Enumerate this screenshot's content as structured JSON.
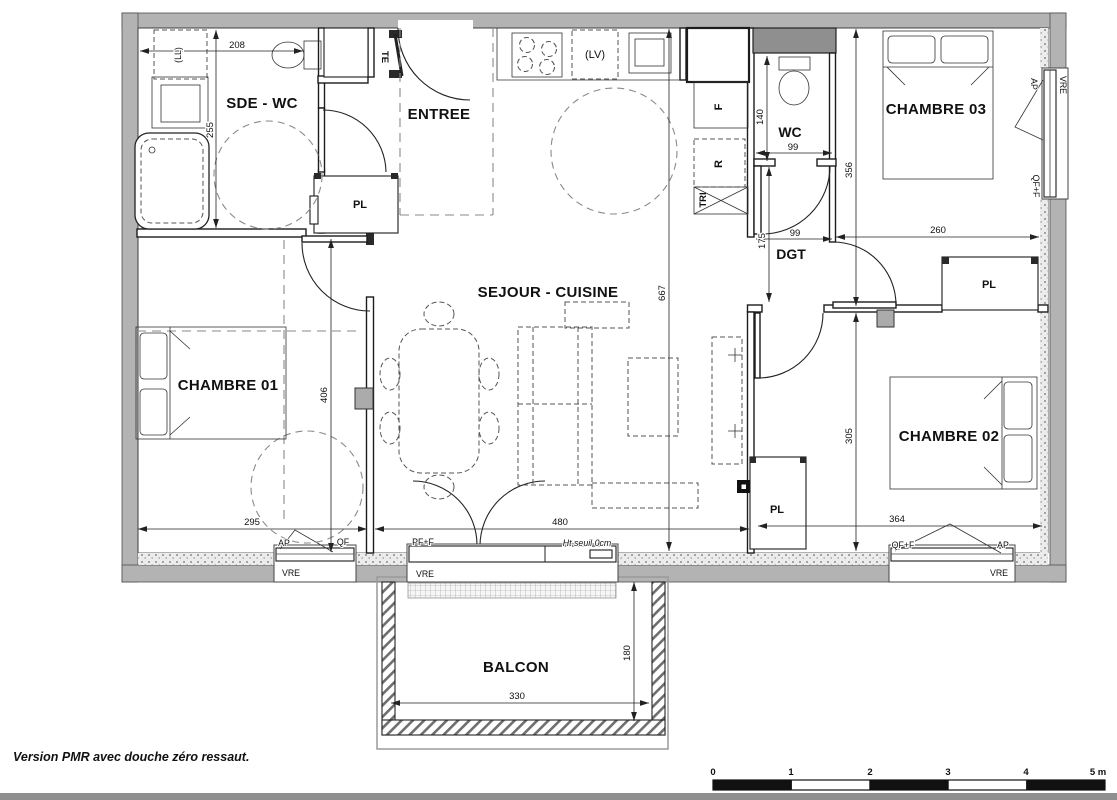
{
  "rooms": {
    "sde_wc": "SDE - WC",
    "entree": "ENTREE",
    "wc": "WC",
    "chambre03": "CHAMBRE 03",
    "dgt": "DGT",
    "sejour_cuisine": "SEJOUR - CUISINE",
    "chambre01": "CHAMBRE 01",
    "chambre02": "CHAMBRE 02",
    "balcon": "BALCON"
  },
  "closets": {
    "pl_entree": "PL",
    "pl_chambre02": "PL",
    "pl_sejour": "PL",
    "te": "TE"
  },
  "appliances": {
    "lave_linge": "(LL)",
    "lave_vaisselle": "(LV)",
    "frigo": "F",
    "rangement": "R",
    "tri": "TRI"
  },
  "dimensions": {
    "sde_largeur": "208",
    "sde_profondeur": "255",
    "wc_profondeur": "140",
    "wc_largeur": "99",
    "aile_droite_hauteur": "356",
    "dgt_largeur": "99",
    "dgt_longueur": "175",
    "chambre03_largeur": "260",
    "sejour_hauteur": "667",
    "chambre01_hauteur": "406",
    "chambre01_largeur": "295",
    "sejour_largeur": "480",
    "chambre02_hauteur": "305",
    "chambre02_largeur": "364",
    "balcon_largeur": "330",
    "balcon_profondeur": "180"
  },
  "openings": {
    "w1_ap": "AP",
    "w1_qf": "QF",
    "w1_vre": "VRE",
    "balcon_pff": "PF+F",
    "balcon_seuil": "Ht seuil 0cm",
    "balcon_vre": "VRE",
    "w2_qff": "QF+F",
    "w2_ap": "AP",
    "w2_vre": "VRE",
    "w3_ap": "AP",
    "w3_qff": "QF+F",
    "w3_vre": "VRE"
  },
  "scale_bar": {
    "ticks": [
      "0",
      "1",
      "2",
      "3",
      "4"
    ],
    "unit_label": "5 m"
  },
  "note": {
    "text": "Version PMR avec douche zéro ressaut."
  },
  "colors": {
    "wall": "#b3b3b3",
    "note_red": "#e8312a",
    "line": "#222222"
  }
}
